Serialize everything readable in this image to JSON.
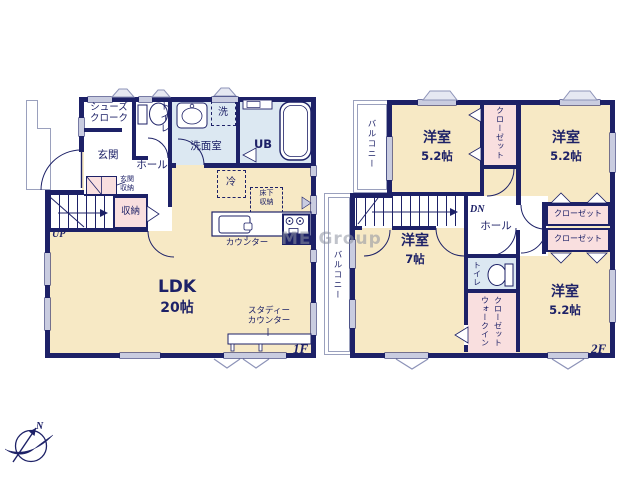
{
  "watermark": "ME Group",
  "colors": {
    "wall": "#1d2167",
    "room_cream": "#f7e9c5",
    "room_blue": "#dce8f2",
    "room_pink": "#f9dfdf",
    "window": "#c9cce0"
  },
  "compass": {
    "north_label": "N"
  },
  "floor1": {
    "floor_label": "1F",
    "shoes_cloak_line1": "シューズ",
    "shoes_cloak_line2": "クローク",
    "toilet": "トイレ",
    "washer": "洗",
    "washroom": "洗面室",
    "bath": "UB",
    "entrance": "玄関",
    "hall": "ホール",
    "entrance_storage_line1": "玄関",
    "entrance_storage_line2": "収納",
    "storage": "収納",
    "stairs_up": "UP",
    "fridge": "冷",
    "underfloor_line1": "床下",
    "underfloor_line2": "収納",
    "kitchen_counter": "カウンター",
    "ldk_name": "LDK",
    "ldk_size": "20帖",
    "study_counter_line1": "スタディー",
    "study_counter_line2": "カウンター"
  },
  "floor2": {
    "floor_label": "2F",
    "balcony_top": "バルコニー",
    "balcony_left": "バルコニー",
    "room_nw_name": "洋室",
    "room_nw_size": "5.2帖",
    "closet_mid": "クローゼット",
    "room_ne_name": "洋室",
    "room_ne_size": "5.2帖",
    "stairs_down": "DN",
    "hall": "ホール",
    "closet_east1": "クローゼット",
    "closet_east2": "クローゼット",
    "room_sw_name": "洋室",
    "room_sw_size": "7帖",
    "toilet": "トイレ",
    "wic_line1": "ウォークイン",
    "wic_line2": "クローゼット",
    "room_se_name": "洋室",
    "room_se_size": "5.2帖"
  }
}
